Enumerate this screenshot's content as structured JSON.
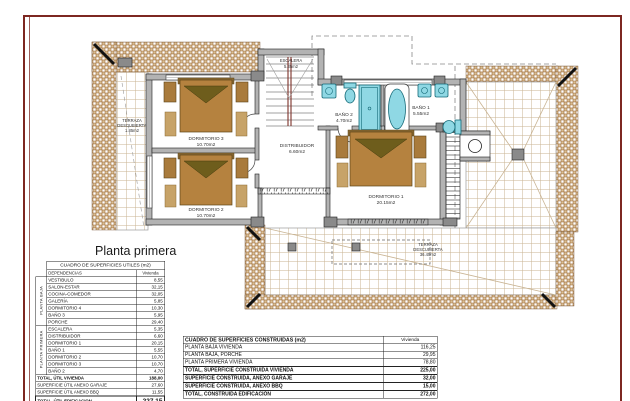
{
  "title": "Planta primera",
  "colors": {
    "page_border": "#7d2721",
    "wall_fill": "#b3b3b3",
    "tile": "#d8bd92",
    "tile_line": "#9c6a38",
    "grid_line": "#c9b493",
    "fixture": "#8fd8e4",
    "fixture_dark": "#156a78",
    "bed": "#b5823f",
    "bed_dark": "#5c4518",
    "pillow": "#6e5d1c",
    "furniture": "#a97b3c",
    "rug": "#c7a368",
    "rail": "#7c3128"
  },
  "plan": {
    "rooms": {
      "dormitorio3": {
        "name": "DORMITORIO 3",
        "area": "10.70m2"
      },
      "dormitorio2": {
        "name": "DORMITORIO 2",
        "area": "10.70m2"
      },
      "dormitorio1": {
        "name": "DORMITORIO 1",
        "area": "20.15m2"
      },
      "distribuidor": {
        "name": "DISTRIBUIDOR",
        "area": "6.60m2"
      },
      "escalera": {
        "name": "ESCALERA",
        "area": "5.35m2"
      },
      "bano1": {
        "name": "BAÑO 1",
        "area": "5.55m2"
      },
      "bano2": {
        "name": "BAÑO 2",
        "area": "4.70m2"
      },
      "terraza_left": {
        "name_line1": "TERRAZA",
        "name_line2": "DESCUBIERTA",
        "area": "1.85m2"
      },
      "terraza_bottom": {
        "name_line1": "TERRAZA",
        "name_line2": "DESCUBIERTA",
        "area": "36.45m2"
      }
    }
  },
  "tables": {
    "utiles": {
      "title": "CUADRO DE SUPERFICIES UTILES (m2)",
      "col_dependencias": "DEPENDENCIAS",
      "col_vivienda": "Vivienda",
      "groups": [
        {
          "label": "PLANTA BAJA",
          "rows": [
            [
              "VESTIBULO",
              "8,55"
            ],
            [
              "SALON-ESTAR",
              "32,15"
            ],
            [
              "COCINA-COMEDOR",
              "32,05"
            ],
            [
              "GALERÍA",
              "5,85"
            ],
            [
              "DORMITORIO 4",
              "10,30"
            ],
            [
              "BAÑO 3",
              "5,95"
            ],
            [
              "PORCHE",
              "29,40"
            ]
          ]
        },
        {
          "label": "PLANTA PRIMERA",
          "rows": [
            [
              "ESCALERA",
              "5,35"
            ],
            [
              "DISTRIBUIDOR",
              "6,60"
            ],
            [
              "DORMITORIO 1",
              "20,15"
            ],
            [
              "BAÑO 1",
              "5,55"
            ],
            [
              "DORMITORIO 2",
              "10,70"
            ],
            [
              "DORMITORIO 3",
              "10,70"
            ],
            [
              "BAÑO 2",
              "4,70"
            ]
          ]
        }
      ],
      "totals": [
        {
          "label": "TOTAL, ÚTIL VIVIENDA",
          "value": "188,00",
          "bold": true,
          "big": false
        },
        {
          "label": "SUPERFICIE ÚTIL ANEXO GARAJE",
          "value": "27,60",
          "bold": false,
          "big": false
        },
        {
          "label": "SUPERFICIE ÚTIL ANEXO BBQ",
          "value": "11,55",
          "bold": false,
          "big": false
        },
        {
          "label": "TOTAL, ÚTIL EDIFICACION",
          "value": "227,15",
          "bold": true,
          "big": true
        }
      ]
    },
    "construidas": {
      "title": "CUADRO DE SUPERFICIES CONSTRUIDAS (m2)",
      "col_vivienda": "Vivienda",
      "rows": [
        {
          "label": "PLANTA BAJA VIVIENDA",
          "value": "116,25",
          "bold": false
        },
        {
          "label": "PLANTA BAJA, PORCHE",
          "value": "29,95",
          "bold": false
        },
        {
          "label": "PLANTA PRIMERA VIVIENDA",
          "value": "78,80",
          "bold": false
        },
        {
          "label": "TOTAL, SUPERFICIE CONSTRUIDA VIVIENDA",
          "value": "225,00",
          "bold": true
        },
        {
          "label": "SUPERFICIE CONSTRUIDA, ANEXO GARAJE",
          "value": "32,00",
          "bold": true
        },
        {
          "label": "SUPERFICIE CONSTRUIDA, ANEXO BBQ",
          "value": "15,00",
          "bold": true
        },
        {
          "label": "TOTAL, CONSTRUIDA EDIFICACIÓN",
          "value": "272,00",
          "bold": true
        }
      ]
    }
  }
}
